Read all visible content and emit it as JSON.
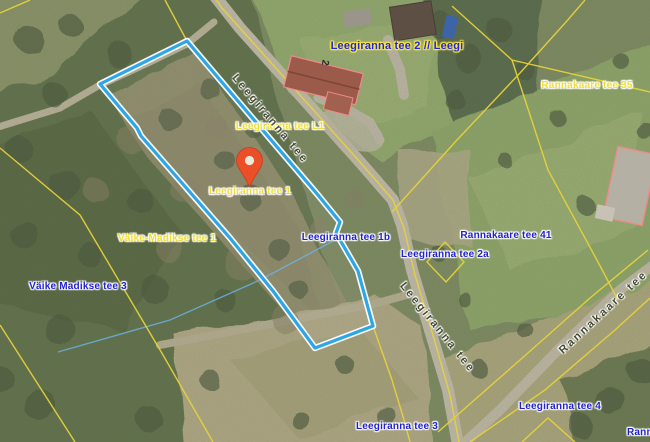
{
  "map": {
    "type": "cadastral-orthophoto",
    "highlighted_parcel": "Leegiranna tee 1",
    "marker": {
      "kind": "location-pin",
      "color": "#ea4f28"
    }
  },
  "labels": {
    "leegi2": {
      "text": "Leegiranna tee 2 // Leegi"
    },
    "rannakaare35": {
      "text": "Rannakaare tee 35"
    },
    "leegirannaL1": {
      "text": "Leegiranna tee L1"
    },
    "leegiranna1": {
      "text": "Leegiranna tee 1"
    },
    "vaikemadikse1": {
      "text": "Väike-Madikse tee 1"
    },
    "leegiranna1b": {
      "text": "Leegiranna tee 1b"
    },
    "rannakaare41": {
      "text": "Rannakaare tee 41"
    },
    "leegiranna2a": {
      "text": "Leegiranna tee 2a"
    },
    "vaikemadikse3": {
      "text": "Väike Madikse tee 3"
    },
    "leegiranna4": {
      "text": "Leegiranna tee 4"
    },
    "leegiranna3": {
      "text": "Leegiranna tee 3"
    },
    "rann_partial": {
      "text": "Rann"
    },
    "house_number": {
      "text": "2"
    }
  },
  "road_labels": {
    "leegiranna_upper": {
      "text": "Leegiranna tee"
    },
    "leegiranna_lower": {
      "text": "Leegiranna tee"
    },
    "rannakaare": {
      "text": "Rannakaare tee"
    }
  },
  "colors": {
    "parcel_highlight": "#2da6e8",
    "parcel_casing": "#ffffff",
    "cadastral_line": "#e6d23a",
    "building_outline": "#f08a8a",
    "address_label_yellow": "#f2df34",
    "address_label_blue": "#2121cf",
    "marker_fill": "#ea4f28",
    "road_label": "#454a35"
  }
}
